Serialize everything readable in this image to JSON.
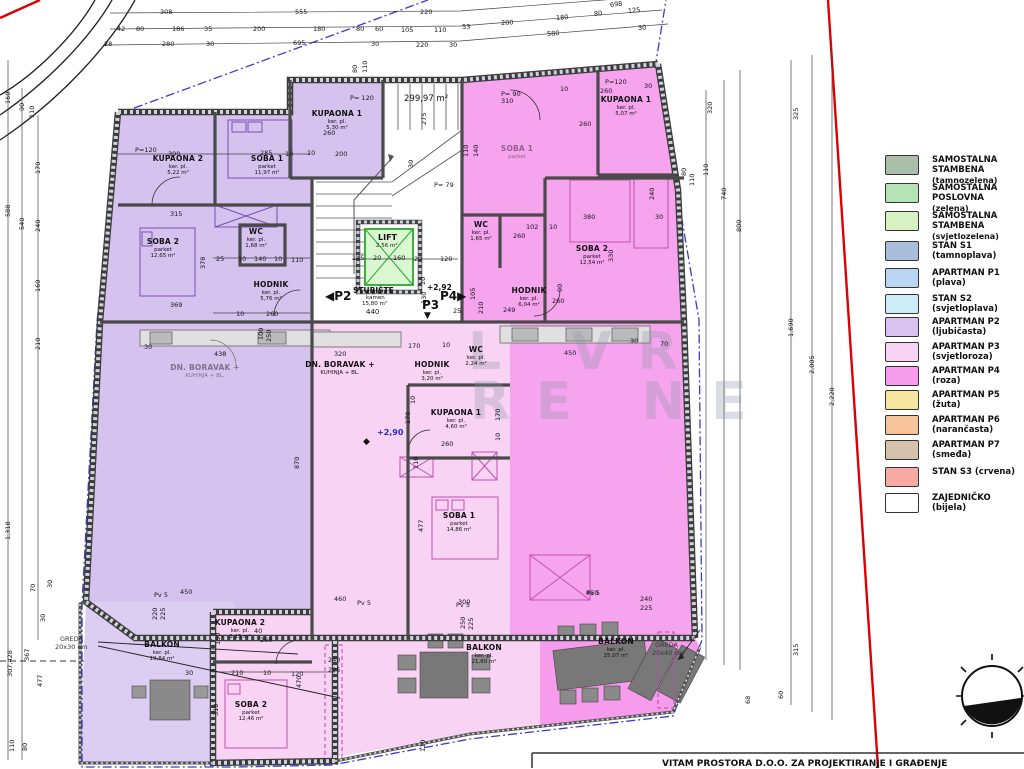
{
  "title_block": {
    "text": "VITAM PROSTORA D.O.O. ZA PROJEKTIRANJE I GRAĐENJE"
  },
  "watermark": {
    "line1": "L  VR",
    "line2": "RE NE"
  },
  "colors": {
    "p2_violet": "#d6c2ef",
    "p2_balcony": "#dccdf2",
    "p3_lightpink": "#f8d3f3",
    "p4_magenta": "#f7a4ee",
    "lift_green": "#2ea52e",
    "lift_fill": "#d9f7d0",
    "boundary_red": "#dd0000",
    "boundary_blue": "#3a3ad0",
    "wall": "#555555"
  },
  "legend": {
    "items": [
      {
        "label": "SAMOSTALNA STAMBENA",
        "sub": "(tamnozelena)",
        "color": "#a9bfa9",
        "y": 155
      },
      {
        "label": "SAMOSTALNA POSLOVNA",
        "sub": "(zelena)",
        "color": "#b5e3b5",
        "y": 183
      },
      {
        "label": "SAMOSTALNA STAMBENA",
        "sub": "(svjetlozelena)",
        "color": "#d9f2c4",
        "y": 211
      },
      {
        "label": "STAN S1  (tamnoplava)",
        "sub": "",
        "color": "#a9bedb",
        "y": 241
      },
      {
        "label": "APARTMAN P1  (plava)",
        "sub": "",
        "color": "#b9d7f2",
        "y": 268
      },
      {
        "label": "STAN S2  (svjetloplava)",
        "sub": "",
        "color": "#cdeef7",
        "y": 294
      },
      {
        "label": "APARTMAN P2  (ljubičasta)",
        "sub": "",
        "color": "#d9c2f0",
        "y": 317
      },
      {
        "label": "APARTMAN P3  (svjetloroza)",
        "sub": "",
        "color": "#f7d4f4",
        "y": 342
      },
      {
        "label": "APARTMAN P4  (roza)",
        "sub": "",
        "color": "#f79bec",
        "y": 366
      },
      {
        "label": "APARTMAN P5  (žuta)",
        "sub": "",
        "color": "#f7e6a0",
        "y": 390
      },
      {
        "label": "APARTMAN P6  (narančasta)",
        "sub": "",
        "color": "#f7c49c",
        "y": 415
      },
      {
        "label": "APARTMAN P7  (smeđa)",
        "sub": "",
        "color": "#d4c2ad",
        "y": 440
      },
      {
        "label": "STAN S3  (crvena)",
        "sub": "",
        "color": "#f7a9a4",
        "y": 467
      },
      {
        "label": "ZAJEDNIČKO  (bijela)",
        "sub": "",
        "color": "#ffffff",
        "y": 493
      }
    ]
  },
  "core": {
    "lift_label": "LIFT",
    "lift_area": "2.56 m²",
    "stair_label": "STUBIŠTE",
    "stair_floor": "kamen",
    "stair_area": "15,80 m²",
    "stair_dim": "440",
    "p2_marker": "◀P2",
    "p3_marker": "P3",
    "p3_arrow": "▼",
    "p4_marker": "P4▶",
    "level_upper": "+2,92",
    "level_main": "+2,90",
    "level_symbol": "◆",
    "total_area": "299,97 m²"
  },
  "annotations": {
    "greda_left_1": "GREDA",
    "greda_left_2": "20x30 cm",
    "greda_right_1": "GREDA",
    "greda_right_2": "20x40 cm"
  },
  "plan": {
    "rooms": [
      {
        "n": "KUPAONA 2",
        "s": "ker. pl.",
        "a": "5,22 m²",
        "x": 178,
        "y": 155
      },
      {
        "n": "SOBA 1",
        "s": "parket",
        "a": "11,97 m²",
        "x": 267,
        "y": 155
      },
      {
        "n": "KUPAONA 1",
        "s": "ker. pl.",
        "a": "5,30 m²",
        "x": 337,
        "y": 110
      },
      {
        "n": "SOBA 2",
        "s": "parket",
        "a": "12,65 m²",
        "x": 163,
        "y": 238
      },
      {
        "n": "WC",
        "s": "ker. pl.",
        "a": "1,68 m²",
        "x": 256,
        "y": 228
      },
      {
        "n": "HODNIK",
        "s": "ker. pl.",
        "a": "5,76 m²",
        "x": 271,
        "y": 281
      },
      {
        "n": "BALKON",
        "s": "ker. pl.",
        "a": "19,84 m²",
        "x": 162,
        "y": 641
      },
      {
        "n": "DN. BORAVAK +",
        "s": "KUHINJA + BL.",
        "a": "",
        "x": 205,
        "y": 364,
        "faint": true
      },
      {
        "n": "DN. BORAVAK +",
        "s": "KUHINJA + BL.",
        "a": "",
        "x": 340,
        "y": 361
      },
      {
        "n": "HODNIK",
        "s": "ker. pl.",
        "a": "3,20 m²",
        "x": 432,
        "y": 361
      },
      {
        "n": "WC",
        "s": "ker. pl.",
        "a": "2,24 m²",
        "x": 476,
        "y": 346
      },
      {
        "n": "KUPAONA 1",
        "s": "ker. pl.",
        "a": "4,60 m²",
        "x": 456,
        "y": 409
      },
      {
        "n": "SOBA 1",
        "s": "parket",
        "a": "14,86 m²",
        "x": 459,
        "y": 512
      },
      {
        "n": "KUPAONA 2",
        "s": "ker. pl.",
        "a": "3,15 m²",
        "x": 240,
        "y": 619
      },
      {
        "n": "SOBA 2",
        "s": "parket",
        "a": "12,46 m²",
        "x": 251,
        "y": 701
      },
      {
        "n": "BALKON",
        "s": "ker. pl.",
        "a": "21,60 m²",
        "x": 484,
        "y": 644
      },
      {
        "n": "KUPAONA 1",
        "s": "ker. pl.",
        "a": "5,07 m²",
        "x": 626,
        "y": 96
      },
      {
        "n": "SOBA 2",
        "s": "parket",
        "a": "12,54 m²",
        "x": 592,
        "y": 245
      },
      {
        "n": "WC",
        "s": "ker. pl.",
        "a": "1,65 m²",
        "x": 481,
        "y": 221
      },
      {
        "n": "HODNIK",
        "s": "ker. pl.",
        "a": "6,04 m²",
        "x": 529,
        "y": 287
      },
      {
        "n": "BALKON",
        "s": "ker. pl.",
        "a": "25,07 m²",
        "x": 616,
        "y": 638
      },
      {
        "n": "SOBA 1",
        "s": "parket",
        "a": "",
        "x": 517,
        "y": 145,
        "faint": true
      }
    ],
    "dims": [
      {
        "t": "308",
        "x": 160,
        "y": 8
      },
      {
        "t": "555",
        "x": 295,
        "y": 8
      },
      {
        "t": "220",
        "x": 420,
        "y": 8
      },
      {
        "t": "698",
        "x": 610,
        "y": 1,
        "r": -6
      },
      {
        "t": "80",
        "x": 594,
        "y": 10,
        "r": -5
      },
      {
        "t": "125",
        "x": 628,
        "y": 7,
        "r": -5
      },
      {
        "t": "180",
        "x": 556,
        "y": 14,
        "r": -4
      },
      {
        "t": "200",
        "x": 501,
        "y": 19,
        "r": -3
      },
      {
        "t": "53",
        "x": 462,
        "y": 23,
        "r": -2
      },
      {
        "t": "42",
        "x": 117,
        "y": 25
      },
      {
        "t": "80",
        "x": 136,
        "y": 25
      },
      {
        "t": "186",
        "x": 172,
        "y": 25
      },
      {
        "t": "35",
        "x": 204,
        "y": 25
      },
      {
        "t": "200",
        "x": 253,
        "y": 25
      },
      {
        "t": "180",
        "x": 313,
        "y": 25
      },
      {
        "t": "80",
        "x": 356,
        "y": 25
      },
      {
        "t": "60",
        "x": 375,
        "y": 25
      },
      {
        "t": "105",
        "x": 401,
        "y": 26
      },
      {
        "t": "110",
        "x": 434,
        "y": 26
      },
      {
        "t": "28",
        "x": 104,
        "y": 40
      },
      {
        "t": "280",
        "x": 162,
        "y": 40
      },
      {
        "t": "30",
        "x": 206,
        "y": 40
      },
      {
        "t": "695",
        "x": 293,
        "y": 39
      },
      {
        "t": "30",
        "x": 371,
        "y": 40
      },
      {
        "t": "220",
        "x": 416,
        "y": 41
      },
      {
        "t": "30",
        "x": 449,
        "y": 41
      },
      {
        "t": "580",
        "x": 547,
        "y": 30,
        "r": -4
      },
      {
        "t": "30",
        "x": 638,
        "y": 24,
        "r": -4
      },
      {
        "t": "160",
        "x": 8,
        "y": 100,
        "r": -90
      },
      {
        "t": "90",
        "x": 22,
        "y": 107,
        "r": -90
      },
      {
        "t": "110",
        "x": 32,
        "y": 114,
        "r": -90
      },
      {
        "t": "588",
        "x": 8,
        "y": 213,
        "r": -90
      },
      {
        "t": "540",
        "x": 22,
        "y": 226,
        "r": -90
      },
      {
        "t": "170",
        "x": 38,
        "y": 170,
        "r": -90
      },
      {
        "t": "240",
        "x": 38,
        "y": 228,
        "r": -90
      },
      {
        "t": "160",
        "x": 38,
        "y": 288,
        "r": -90
      },
      {
        "t": "210",
        "x": 38,
        "y": 346,
        "r": -90
      },
      {
        "t": "1,318",
        "x": 8,
        "y": 536,
        "r": -90
      },
      {
        "t": "307,428",
        "x": 10,
        "y": 673,
        "r": -90
      },
      {
        "t": "367",
        "x": 27,
        "y": 657,
        "r": -90
      },
      {
        "t": "477",
        "x": 40,
        "y": 683,
        "r": -90
      },
      {
        "t": "70",
        "x": 33,
        "y": 588,
        "r": -90
      },
      {
        "t": "30",
        "x": 50,
        "y": 584,
        "r": -90
      },
      {
        "t": "30",
        "x": 43,
        "y": 618,
        "r": -90
      },
      {
        "t": "80",
        "x": 25,
        "y": 747,
        "r": -90
      },
      {
        "t": "110",
        "x": 12,
        "y": 748,
        "r": -90
      },
      {
        "t": "320",
        "x": 710,
        "y": 110,
        "r": -90
      },
      {
        "t": "740",
        "x": 724,
        "y": 196,
        "r": -90
      },
      {
        "t": "800",
        "x": 739,
        "y": 228,
        "r": -90
      },
      {
        "t": "110",
        "x": 706,
        "y": 172,
        "r": -90
      },
      {
        "t": "325",
        "x": 796,
        "y": 116,
        "r": -90
      },
      {
        "t": "1,690",
        "x": 791,
        "y": 333,
        "r": -90
      },
      {
        "t": "2,005",
        "x": 812,
        "y": 370,
        "r": -90
      },
      {
        "t": "2,220",
        "x": 832,
        "y": 402,
        "r": -90
      },
      {
        "t": "315",
        "x": 796,
        "y": 652,
        "r": -90
      },
      {
        "t": "60",
        "x": 781,
        "y": 695,
        "r": -90
      },
      {
        "t": "68",
        "x": 748,
        "y": 700,
        "r": -90
      },
      {
        "t": "80",
        "x": 684,
        "y": 172,
        "r": -90
      },
      {
        "t": "110",
        "x": 692,
        "y": 182,
        "r": -90
      },
      {
        "t": "P=120",
        "x": 135,
        "y": 146
      },
      {
        "t": "390",
        "x": 168,
        "y": 150
      },
      {
        "t": "10",
        "x": 285,
        "y": 150
      },
      {
        "t": "285",
        "x": 260,
        "y": 149
      },
      {
        "t": "315",
        "x": 170,
        "y": 210
      },
      {
        "t": "378",
        "x": 203,
        "y": 265,
        "r": -90
      },
      {
        "t": "25",
        "x": 216,
        "y": 255
      },
      {
        "t": "10",
        "x": 238,
        "y": 255
      },
      {
        "t": "140",
        "x": 254,
        "y": 255
      },
      {
        "t": "10",
        "x": 274,
        "y": 255
      },
      {
        "t": "110",
        "x": 291,
        "y": 256
      },
      {
        "t": "369",
        "x": 170,
        "y": 301
      },
      {
        "t": "260",
        "x": 266,
        "y": 310
      },
      {
        "t": "10",
        "x": 236,
        "y": 310
      },
      {
        "t": "P= 120",
        "x": 350,
        "y": 94
      },
      {
        "t": "260",
        "x": 323,
        "y": 129
      },
      {
        "t": "200",
        "x": 335,
        "y": 150
      },
      {
        "t": "10",
        "x": 307,
        "y": 149
      },
      {
        "t": "275",
        "x": 424,
        "y": 121,
        "r": -90
      },
      {
        "t": "110",
        "x": 466,
        "y": 153,
        "r": -90
      },
      {
        "t": "140",
        "x": 476,
        "y": 153,
        "r": -90
      },
      {
        "t": "30",
        "x": 411,
        "y": 164,
        "r": -90
      },
      {
        "t": "80",
        "x": 355,
        "y": 69,
        "r": -90
      },
      {
        "t": "110",
        "x": 365,
        "y": 69,
        "r": -90
      },
      {
        "t": "P= 79",
        "x": 434,
        "y": 181
      },
      {
        "t": "P= 90",
        "x": 501,
        "y": 90
      },
      {
        "t": "310",
        "x": 501,
        "y": 97
      },
      {
        "t": "10",
        "x": 560,
        "y": 85
      },
      {
        "t": "P=120",
        "x": 605,
        "y": 78
      },
      {
        "t": "260",
        "x": 600,
        "y": 87
      },
      {
        "t": "30",
        "x": 644,
        "y": 82
      },
      {
        "t": "145",
        "x": 352,
        "y": 254
      },
      {
        "t": "20",
        "x": 373,
        "y": 254
      },
      {
        "t": "160",
        "x": 393,
        "y": 254
      },
      {
        "t": "20",
        "x": 414,
        "y": 255
      },
      {
        "t": "120",
        "x": 440,
        "y": 255
      },
      {
        "t": "130",
        "x": 424,
        "y": 300,
        "r": -90
      },
      {
        "t": "20",
        "x": 423,
        "y": 281,
        "r": -90
      },
      {
        "t": "105",
        "x": 473,
        "y": 296,
        "r": -90
      },
      {
        "t": "210",
        "x": 481,
        "y": 310,
        "r": -90
      },
      {
        "t": "25",
        "x": 453,
        "y": 307
      },
      {
        "t": "260",
        "x": 579,
        "y": 120
      },
      {
        "t": "380",
        "x": 583,
        "y": 213
      },
      {
        "t": "30",
        "x": 655,
        "y": 213
      },
      {
        "t": "102",
        "x": 526,
        "y": 223
      },
      {
        "t": "10",
        "x": 549,
        "y": 223
      },
      {
        "t": "260",
        "x": 513,
        "y": 232
      },
      {
        "t": "330",
        "x": 611,
        "y": 258,
        "r": -90
      },
      {
        "t": "249",
        "x": 503,
        "y": 306
      },
      {
        "t": "90",
        "x": 560,
        "y": 288,
        "r": -90
      },
      {
        "t": "260",
        "x": 552,
        "y": 297
      },
      {
        "t": "240",
        "x": 652,
        "y": 196,
        "r": -90
      },
      {
        "t": "320",
        "x": 334,
        "y": 350
      },
      {
        "t": "170",
        "x": 408,
        "y": 342
      },
      {
        "t": "10",
        "x": 442,
        "y": 341
      },
      {
        "t": "450",
        "x": 564,
        "y": 349
      },
      {
        "t": "30",
        "x": 630,
        "y": 337
      },
      {
        "t": "70",
        "x": 660,
        "y": 340
      },
      {
        "t": "170",
        "x": 408,
        "y": 420,
        "r": -90
      },
      {
        "t": "10",
        "x": 413,
        "y": 400,
        "r": -90
      },
      {
        "t": "170",
        "x": 498,
        "y": 417,
        "r": -90
      },
      {
        "t": "10",
        "x": 498,
        "y": 437,
        "r": -90
      },
      {
        "t": "260",
        "x": 441,
        "y": 440
      },
      {
        "t": "110",
        "x": 416,
        "y": 465,
        "r": -90
      },
      {
        "t": "477",
        "x": 421,
        "y": 528,
        "r": -90
      },
      {
        "t": "870",
        "x": 297,
        "y": 465,
        "r": -90
      },
      {
        "t": "438",
        "x": 214,
        "y": 350
      },
      {
        "t": "100",
        "x": 261,
        "y": 336,
        "r": -90
      },
      {
        "t": "250",
        "x": 269,
        "y": 338,
        "r": -90
      },
      {
        "t": "30",
        "x": 144,
        "y": 343
      },
      {
        "t": "30",
        "x": 185,
        "y": 669
      },
      {
        "t": "210",
        "x": 231,
        "y": 669
      },
      {
        "t": "10",
        "x": 263,
        "y": 669
      },
      {
        "t": "120",
        "x": 291,
        "y": 670
      },
      {
        "t": "470",
        "x": 299,
        "y": 684,
        "r": -90
      },
      {
        "t": "150",
        "x": 218,
        "y": 641,
        "r": -90
      },
      {
        "t": "40",
        "x": 254,
        "y": 627
      },
      {
        "t": "260",
        "x": 260,
        "y": 636
      },
      {
        "t": "310",
        "x": 216,
        "y": 712,
        "r": -90
      },
      {
        "t": "220",
        "x": 155,
        "y": 616,
        "r": -90
      },
      {
        "t": "225",
        "x": 163,
        "y": 616,
        "r": -90
      },
      {
        "t": "250",
        "x": 463,
        "y": 625,
        "r": -90
      },
      {
        "t": "225",
        "x": 471,
        "y": 626,
        "r": -90
      },
      {
        "t": "240",
        "x": 328,
        "y": 656
      },
      {
        "t": "225",
        "x": 328,
        "y": 666
      },
      {
        "t": "240",
        "x": 640,
        "y": 595
      },
      {
        "t": "225",
        "x": 640,
        "y": 604
      },
      {
        "t": "450",
        "x": 180,
        "y": 588
      },
      {
        "t": "460",
        "x": 334,
        "y": 595
      },
      {
        "t": "300",
        "x": 458,
        "y": 598
      },
      {
        "t": "450",
        "x": 586,
        "y": 589
      },
      {
        "t": "110",
        "x": 423,
        "y": 748,
        "r": -90
      },
      {
        "t": "Pv 5",
        "x": 154,
        "y": 591
      },
      {
        "t": "Pv 5",
        "x": 357,
        "y": 599
      },
      {
        "t": "Pv 5",
        "x": 456,
        "y": 601
      },
      {
        "t": "Pv 5",
        "x": 586,
        "y": 589
      }
    ]
  }
}
